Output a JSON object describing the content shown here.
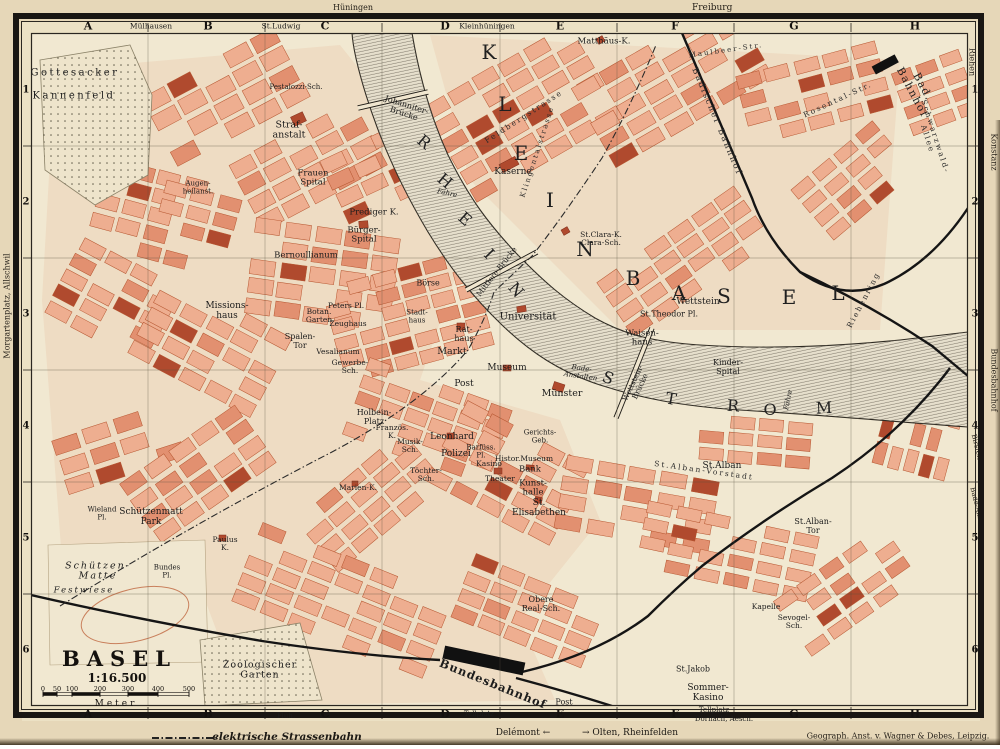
{
  "title": {
    "name": "BASEL",
    "ratio": "1:16.500",
    "meter": "Meter",
    "ticks": [
      "0",
      "50",
      "100",
      "200",
      "300",
      "400",
      "500"
    ]
  },
  "frame": {
    "grid_letters": [
      "A",
      "B",
      "C",
      "D",
      "E",
      "F",
      "G",
      "H"
    ],
    "grid_numbers": [
      "1",
      "2",
      "3",
      "4",
      "5",
      "6"
    ],
    "top_names": [
      {
        "t": "Mülhausen",
        "x": 151
      },
      {
        "t": "St.Ludwig",
        "x": 281
      },
      {
        "t": "Kleinhüningen",
        "x": 487
      }
    ],
    "bottom_names": [
      {
        "t": "Flüh.",
        "x": 286,
        "y": 716
      },
      {
        "t": "Tellplatz",
        "x": 479,
        "y": 714
      },
      {
        "t": "Tellplatz",
        "x": 714,
        "y": 710
      },
      {
        "t": "Dornach, Aesch.",
        "x": 724,
        "y": 719
      }
    ]
  },
  "margins": {
    "top_huningen": "Hüningen",
    "top_freiburg": "Freiburg",
    "left_note": "Morgartenplatz, Allschwil",
    "right_riehen": "Riehen",
    "right_konstanz": "Konstanz",
    "right_bundesbahnhof": "Bundesbahnhof",
    "right_birsfelden": "Birsfelden",
    "right_bade": "Bade-Anst."
  },
  "legend": {
    "tram": "elektrische Strassenbahn",
    "delemont": "Delémont ←",
    "olten": "→ Olten, Rheinfelden",
    "imprint": "Geograph. Anst. v. Wagner & Debes, Leipzig."
  },
  "map": {
    "letters_kleinbasel": [
      {
        "ch": "K",
        "x": 489,
        "y": 52
      },
      {
        "ch": "L",
        "x": 505,
        "y": 104
      },
      {
        "ch": "E",
        "x": 521,
        "y": 153
      },
      {
        "ch": "I",
        "x": 550,
        "y": 200
      },
      {
        "ch": "N",
        "x": 585,
        "y": 249
      },
      {
        "ch": "B",
        "x": 633,
        "y": 278
      },
      {
        "ch": "A",
        "x": 679,
        "y": 293
      },
      {
        "ch": "S",
        "x": 724,
        "y": 296
      },
      {
        "ch": "E",
        "x": 789,
        "y": 297
      },
      {
        "ch": "L",
        "x": 838,
        "y": 293
      }
    ],
    "letters_rheinstrom": [
      {
        "ch": "R",
        "x": 424,
        "y": 142,
        "r": 40
      },
      {
        "ch": "H",
        "x": 445,
        "y": 181,
        "r": 40
      },
      {
        "ch": "E",
        "x": 465,
        "y": 219,
        "r": 42
      },
      {
        "ch": "I",
        "x": 489,
        "y": 254,
        "r": 46
      },
      {
        "ch": "N",
        "x": 516,
        "y": 290,
        "r": 50
      },
      {
        "ch": "S",
        "x": 608,
        "y": 378,
        "r": 22
      },
      {
        "ch": "T",
        "x": 671,
        "y": 399,
        "r": 10
      },
      {
        "ch": "R",
        "x": 733,
        "y": 406,
        "r": 4
      },
      {
        "ch": "O",
        "x": 770,
        "y": 410,
        "r": 0
      },
      {
        "ch": "M",
        "x": 824,
        "y": 408,
        "r": -2
      }
    ],
    "labels": [
      {
        "t": "Gottesacker",
        "x": 75,
        "y": 73,
        "s": 10,
        "w": 2.5,
        "n": "label-gottesacker"
      },
      {
        "t": "Kannenfeld",
        "x": 74,
        "y": 96,
        "s": 10,
        "w": 2.5,
        "n": "label-kannenfeld"
      },
      {
        "t": "Straf-\nanstalt",
        "x": 289,
        "y": 131,
        "s": 9.5
      },
      {
        "t": "Frauen\nSpital",
        "x": 313,
        "y": 179,
        "s": 8.5
      },
      {
        "t": "Prediger K.",
        "x": 374,
        "y": 213,
        "s": 8.5
      },
      {
        "t": "Bürger-\nSpital",
        "x": 364,
        "y": 236,
        "s": 8.5
      },
      {
        "t": "Bernoullianum",
        "x": 306,
        "y": 256,
        "s": 8.5
      },
      {
        "t": "Missions-\nhaus",
        "x": 227,
        "y": 312,
        "s": 9
      },
      {
        "t": "Botan.\nGarten",
        "x": 319,
        "y": 316,
        "s": 7.5
      },
      {
        "t": "Spalen-\nTor",
        "x": 300,
        "y": 342,
        "s": 8
      },
      {
        "t": "Zeughaus",
        "x": 348,
        "y": 324,
        "s": 7.5
      },
      {
        "t": "Peters Pl.",
        "x": 346,
        "y": 306,
        "s": 7.5
      },
      {
        "t": "Vesalianum",
        "x": 338,
        "y": 352,
        "s": 7.5
      },
      {
        "t": "Gewerbe-\nSch.",
        "x": 350,
        "y": 367,
        "s": 7.5
      },
      {
        "t": "Börse",
        "x": 428,
        "y": 284,
        "s": 8
      },
      {
        "t": "Stadt-\nhaus",
        "x": 417,
        "y": 317,
        "s": 7
      },
      {
        "t": "Rat-\nhaus",
        "x": 464,
        "y": 335,
        "s": 8
      },
      {
        "t": "Markt",
        "x": 452,
        "y": 352,
        "s": 9.5,
        "n": "label-markt"
      },
      {
        "t": "Universität",
        "x": 528,
        "y": 317,
        "s": 10,
        "n": "label-universitaet"
      },
      {
        "t": "Museum",
        "x": 507,
        "y": 369,
        "s": 9
      },
      {
        "t": "Post",
        "x": 464,
        "y": 385,
        "s": 9
      },
      {
        "t": "Münster",
        "x": 562,
        "y": 394,
        "s": 9.5,
        "n": "label-muenster"
      },
      {
        "t": "St.Clara-K.\nClara-Sch.",
        "x": 601,
        "y": 239,
        "s": 7.5
      },
      {
        "t": "Kaserne",
        "x": 513,
        "y": 173,
        "s": 9
      },
      {
        "t": "Matthäus-K.",
        "x": 604,
        "y": 42,
        "s": 8.5
      },
      {
        "t": "Wettstein",
        "x": 698,
        "y": 303,
        "s": 9
      },
      {
        "t": "St.Theodor Pl.",
        "x": 669,
        "y": 315,
        "s": 8
      },
      {
        "t": "Waisen-\nhaus",
        "x": 642,
        "y": 339,
        "s": 8.5
      },
      {
        "t": "Kinder-\nSpital",
        "x": 728,
        "y": 368,
        "s": 8
      },
      {
        "t": "St.Alban",
        "x": 722,
        "y": 467,
        "s": 9
      },
      {
        "t": "St.Alban-\nTor",
        "x": 813,
        "y": 527,
        "s": 8
      },
      {
        "t": "Kunst-\nhalle",
        "x": 533,
        "y": 489,
        "s": 8.5
      },
      {
        "t": "Bank",
        "x": 530,
        "y": 470,
        "s": 8.5
      },
      {
        "t": "Histor.Museum",
        "x": 524,
        "y": 459,
        "s": 7.5
      },
      {
        "t": "Kasino",
        "x": 489,
        "y": 464,
        "s": 7.5
      },
      {
        "t": "Theater",
        "x": 500,
        "y": 479,
        "s": 7.5
      },
      {
        "t": "Barfüss.\nPl.",
        "x": 481,
        "y": 452,
        "s": 7
      },
      {
        "t": "Polizei",
        "x": 456,
        "y": 455,
        "s": 9
      },
      {
        "t": "Leonhard",
        "x": 452,
        "y": 438,
        "s": 9
      },
      {
        "t": "Musik-\nSch.",
        "x": 410,
        "y": 446,
        "s": 7.5
      },
      {
        "t": "Französ.\nK.",
        "x": 392,
        "y": 432,
        "s": 7.5
      },
      {
        "t": "Holbein-\nPlatz",
        "x": 374,
        "y": 418,
        "s": 8
      },
      {
        "t": "Töchter-\nSch.",
        "x": 426,
        "y": 475,
        "s": 7.5
      },
      {
        "t": "Marien-K.",
        "x": 358,
        "y": 488,
        "s": 7.5
      },
      {
        "t": "Gerichts-\nGeb.",
        "x": 540,
        "y": 437,
        "s": 7
      },
      {
        "t": "St.\nElisabethen",
        "x": 539,
        "y": 509,
        "s": 9
      },
      {
        "t": "Schützenmatt\nPark",
        "x": 151,
        "y": 518,
        "s": 9,
        "n": "label-schuetzenmatt-park"
      },
      {
        "t": "Wieland\nPl.",
        "x": 102,
        "y": 514,
        "s": 7
      },
      {
        "t": "Paulus\nK.",
        "x": 225,
        "y": 544,
        "s": 7.5
      },
      {
        "t": "Schützen-\nMatte",
        "x": 98,
        "y": 572,
        "s": 9.5,
        "c": "it",
        "w": 2
      },
      {
        "t": "Festwiese",
        "x": 84,
        "y": 591,
        "s": 8.5,
        "c": "it",
        "w": 2
      },
      {
        "t": "Bundes\nPl.",
        "x": 167,
        "y": 572,
        "s": 7
      },
      {
        "t": "Zoologischer\nGarten",
        "x": 260,
        "y": 671,
        "s": 9.5,
        "w": 1,
        "n": "label-zoologischer-garten"
      },
      {
        "t": "Bundesbahnhof",
        "x": 493,
        "y": 684,
        "s": 11.5,
        "r": 22,
        "c": "bd",
        "w": 1,
        "n": "label-bundesbahnhof"
      },
      {
        "t": "Obere\nReal-Sch.",
        "x": 541,
        "y": 605,
        "s": 8
      },
      {
        "t": "Post",
        "x": 564,
        "y": 703,
        "s": 8
      },
      {
        "t": "Sommer-\nKasino",
        "x": 708,
        "y": 694,
        "s": 9
      },
      {
        "t": "St.Jakob",
        "x": 693,
        "y": 670,
        "s": 8
      },
      {
        "t": "Kapelle",
        "x": 766,
        "y": 607,
        "s": 7.5
      },
      {
        "t": "Sevogel-\nSch.",
        "x": 794,
        "y": 622,
        "s": 7.5
      },
      {
        "t": "Bad. Bahnhof",
        "x": 917,
        "y": 90,
        "s": 10.5,
        "r": 62,
        "w": 1.5,
        "n": "label-bad-bahnhof"
      },
      {
        "t": "Badischer Bahnhof",
        "x": 716,
        "y": 122,
        "s": 8.5,
        "r": 67,
        "c": "sp"
      },
      {
        "t": "Johanniter-\nBrücke",
        "x": 405,
        "y": 110,
        "s": 8,
        "r": 18
      },
      {
        "t": "Mittlere Brücke",
        "x": 497,
        "y": 272,
        "s": 7.5,
        "r": -52
      },
      {
        "t": "Wettstein-\nBrücke",
        "x": 637,
        "y": 385,
        "s": 7.5,
        "r": -65
      },
      {
        "t": "Fähre",
        "x": 447,
        "y": 194,
        "s": 7,
        "c": "it",
        "r": 12
      },
      {
        "t": "Fähre",
        "x": 789,
        "y": 400,
        "s": 7,
        "c": "it",
        "r": -78
      },
      {
        "t": "Bade-\nAnstalten",
        "x": 581,
        "y": 373,
        "s": 7,
        "c": "it",
        "r": 8
      },
      {
        "t": "Feldbergstrasse",
        "x": 524,
        "y": 117,
        "s": 7.5,
        "r": -33,
        "c": "sp"
      },
      {
        "t": "Klingentalstrasse",
        "x": 538,
        "y": 152,
        "s": 7,
        "r": -72,
        "c": "sp"
      },
      {
        "t": "Riehenring",
        "x": 864,
        "y": 300,
        "s": 7.5,
        "r": -62,
        "c": "sp"
      },
      {
        "t": "St.Alban-Vorstadt",
        "x": 704,
        "y": 471,
        "s": 7.5,
        "r": 8,
        "c": "sp"
      },
      {
        "t": "Schwarzwald-Allee",
        "x": 931,
        "y": 138,
        "s": 7.5,
        "r": 72,
        "c": "sp"
      },
      {
        "t": "Rosental-Str.",
        "x": 838,
        "y": 100,
        "s": 7.5,
        "r": -25,
        "c": "sp"
      },
      {
        "t": "Maulbeer-Str.",
        "x": 726,
        "y": 51,
        "s": 7,
        "r": -8,
        "c": "sp"
      },
      {
        "t": "Pestalozzi-Sch.",
        "x": 296,
        "y": 88,
        "s": 7
      },
      {
        "t": "Augen-\nheilanst.",
        "x": 198,
        "y": 188,
        "s": 7
      }
    ]
  },
  "colors": {
    "paper": "#e6d7b8",
    "map_bg": "#f1e8d1",
    "block_fill": "#eeae90",
    "block_dark": "#e29070",
    "block_stroke": "#b5552f",
    "landmark": "#b04a2e",
    "water_base": "#e6dfcc",
    "rail": "#151515",
    "ink": "#1c1c1c"
  }
}
